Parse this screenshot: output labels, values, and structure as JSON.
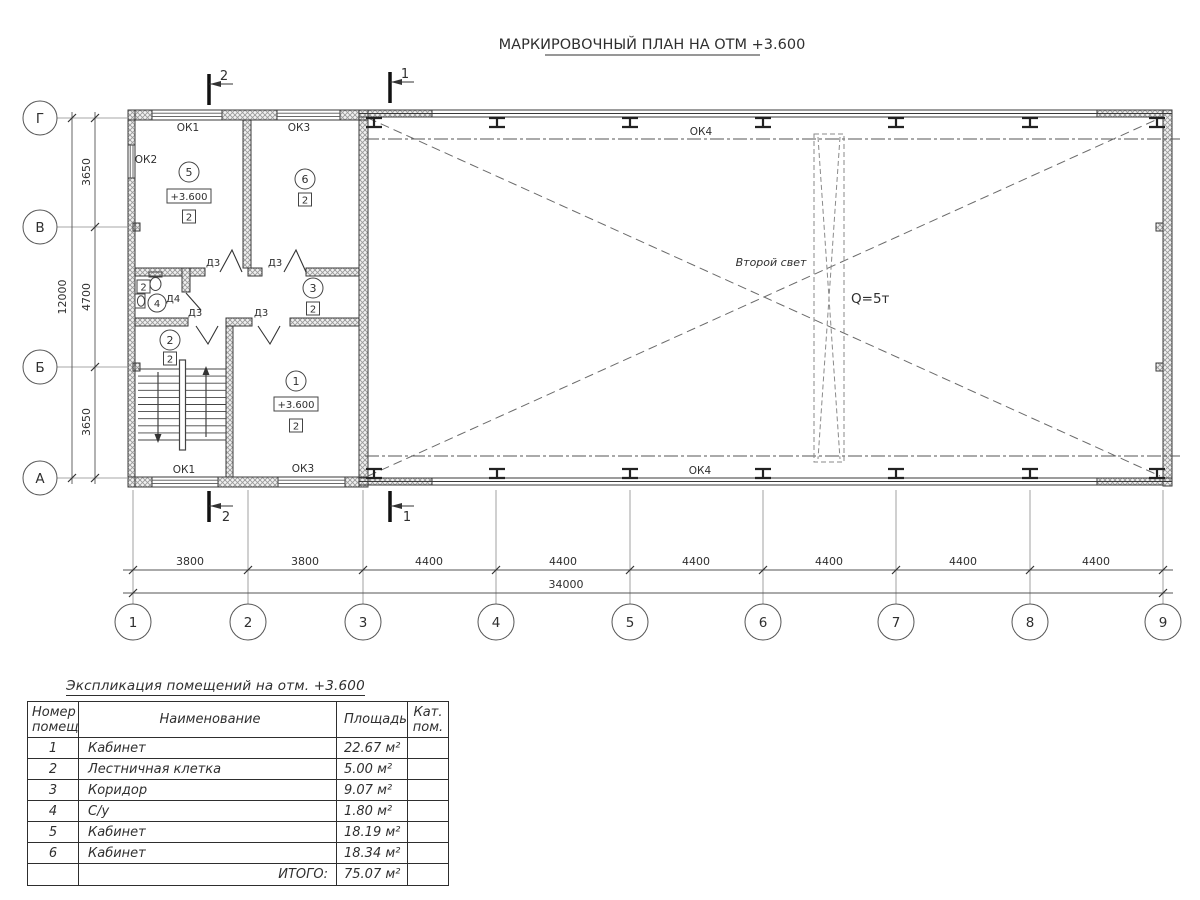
{
  "title": "МАРКИРОВОЧНЫЙ ПЛАН НА ОТМ +3.600",
  "plan": {
    "axes_h": [
      "1",
      "2",
      "3",
      "4",
      "5",
      "6",
      "7",
      "8",
      "9"
    ],
    "axes_v": [
      "Г",
      "В",
      "Б",
      "А"
    ],
    "dims_bottom": [
      "3800",
      "3800",
      "4400",
      "4400",
      "4400",
      "4400",
      "4400",
      "4400"
    ],
    "dim_total_bottom": "34000",
    "dims_left": [
      "3650",
      "4700",
      "3650"
    ],
    "dim_total_left": "12000",
    "section_mark_1": "1",
    "section_mark_2": "2",
    "windows": {
      "ok1": "ОК1",
      "ok2": "ОК2",
      "ok3": "ОК3",
      "ok4": "ОК4"
    },
    "doors": {
      "d3": "Д3",
      "d4": "Д4"
    },
    "rooms": {
      "r1": {
        "num": "1",
        "level": "+3.600",
        "cat": "2"
      },
      "r2": {
        "num": "2",
        "cat": "2"
      },
      "r3": {
        "num": "3",
        "cat": "2"
      },
      "r4": {
        "num": "4",
        "cat": "2"
      },
      "r5": {
        "num": "5",
        "level": "+3.600",
        "cat": "2"
      },
      "r6": {
        "num": "6",
        "cat": "2"
      }
    },
    "hall": {
      "second_light": "Второй свет",
      "crane_capacity": "Q=5т"
    }
  },
  "table": {
    "title": "Экспликация помещений на отм. +3.600",
    "headers": {
      "num_l1": "Номер",
      "num_l2": "помещ.",
      "name": "Наименование",
      "area": "Площадь",
      "cat_l1": "Кат.",
      "cat_l2": "пом."
    },
    "rows": [
      {
        "num": "1",
        "name": "Кабинет",
        "area": "22.67 м²"
      },
      {
        "num": "2",
        "name": "Лестничная клетка",
        "area": "5.00 м²"
      },
      {
        "num": "3",
        "name": "Коридор",
        "area": "9.07 м²"
      },
      {
        "num": "4",
        "name": "С/у",
        "area": "1.80 м²"
      },
      {
        "num": "5",
        "name": "Кабинет",
        "area": "18.19 м²"
      },
      {
        "num": "6",
        "name": "Кабинет",
        "area": "18.34 м²"
      }
    ],
    "total_label": "ИТОГО:",
    "total_area": "75.07 м²"
  }
}
